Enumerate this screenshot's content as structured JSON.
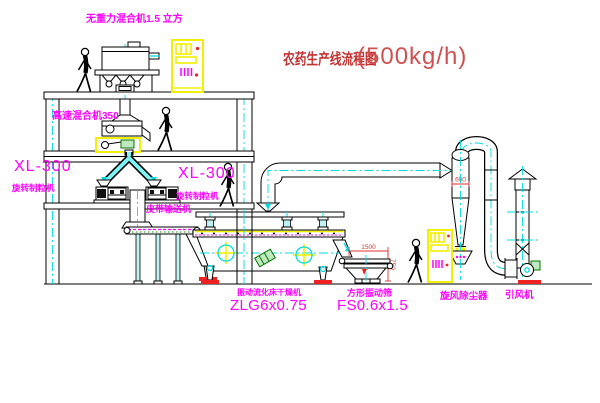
{
  "title": {
    "cn": "农药生产线流程图",
    "capacity": "(500kg/h)"
  },
  "labels": {
    "gravity_mixer": "无重力混合机1.5 立方",
    "high_speed_mixer": "高速混合机350",
    "granulator_left_model": "XL-300",
    "granulator_left_name": "旋转制粒机",
    "granulator_right_model": "XL-300",
    "granulator_right_name": "旋转制粒机",
    "belt_conveyor": "皮带输送机",
    "dryer_name": "振动流化床干燥机",
    "dryer_model": "ZLG6x0.75",
    "sieve_name": "方形振动筛",
    "sieve_model": "FS0.6x1.5",
    "cyclone": "旋风除尘器",
    "fan": "引风机"
  },
  "dimensions": {
    "sieve_length": "1500",
    "sieve_height": "750",
    "cyclone_dia": "600"
  },
  "colors": {
    "label_magenta": "#ff00ff",
    "title_red": "#c23232",
    "dim_red": "#e03232",
    "cad_yellow": "#f0f000",
    "cad_cyan": "#00dcdc"
  }
}
